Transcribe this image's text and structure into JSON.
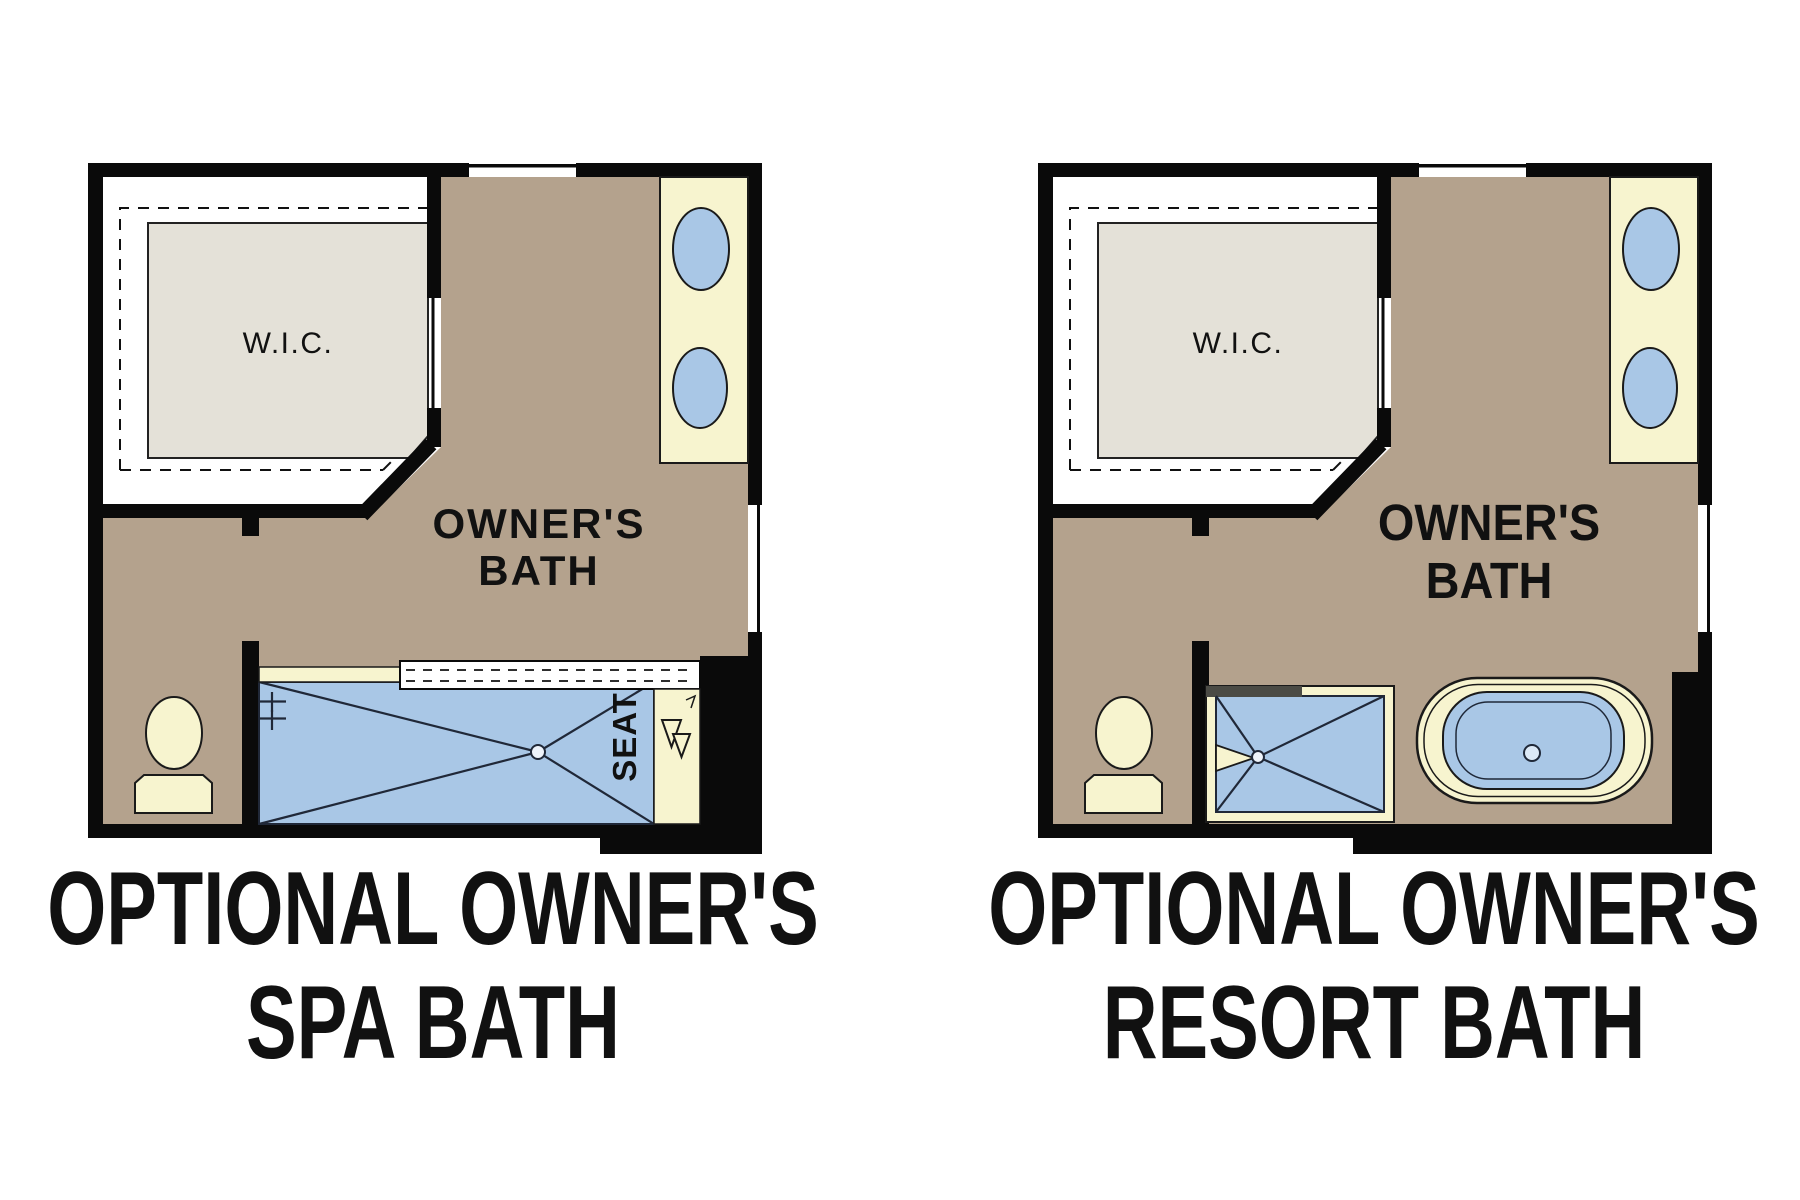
{
  "figure": {
    "type": "floor-plan-options",
    "background": "#ffffff",
    "colors": {
      "floor_tan": "#b4a28d",
      "fixture_cream": "#f7f4cf",
      "fixture_blue": "#a9c7e6",
      "closet_gray": "#e4e1d8",
      "wall_black": "#0a0a0a",
      "shower_header_gray": "#4b4b45",
      "background": "#ffffff"
    },
    "plans": [
      {
        "id": "spa-bath",
        "caption_line1": "OPTIONAL OWNER'S",
        "caption_line2": "SPA BATH",
        "closet_label": "W.I.C.",
        "room_label_line1": "OWNER'S",
        "room_label_line2": "BATH",
        "shower_seat_label": "SEAT",
        "fixtures": [
          "walk-in-closet",
          "double-sink-vanity",
          "toilet",
          "walk-in-shower-with-seat"
        ]
      },
      {
        "id": "resort-bath",
        "caption_line1": "OPTIONAL OWNER'S",
        "caption_line2": "RESORT BATH",
        "closet_label": "W.I.C.",
        "room_label_line1": "OWNER'S",
        "room_label_line2": "BATH",
        "fixtures": [
          "walk-in-closet",
          "double-sink-vanity",
          "toilet",
          "corner-shower",
          "freestanding-tub"
        ]
      }
    ]
  }
}
